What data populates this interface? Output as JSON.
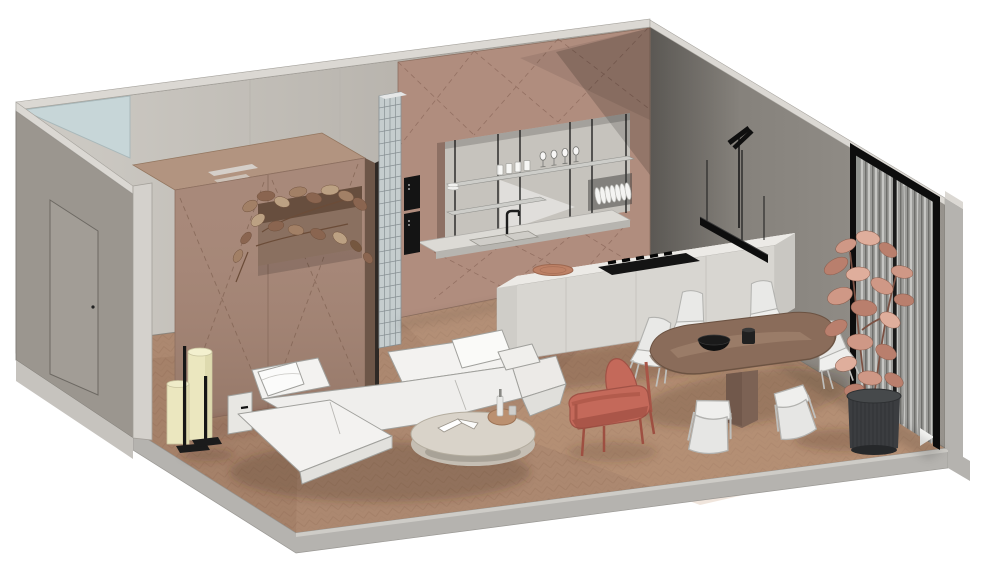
{
  "meta": {
    "title": "Apartment interior - axonometric cutaway 3D render",
    "view": "isometric cutaway on white background",
    "background": "#ffffff"
  },
  "palette": {
    "background": "#ffffff",
    "floor_wood": "#ac8870",
    "floor_line": "#9b7760",
    "slab_face": "#b5b3af",
    "slab_light": "#d0ceca",
    "wall_top_band": "#dbd8d3",
    "wall_light": "#c9c6c0",
    "wall_mid": "#9b968f",
    "wall_dark": "#8e8a83",
    "glass_corner": "#c7d6d8",
    "cabinet": "#b08d7e",
    "cabinet_dark": "#8d7064",
    "cabinet_line": "#8a675a",
    "niche_back": "#c6c3bd",
    "counter": "#dcdad5",
    "glass_block": "#c5cdce",
    "island_top": "#e4e2de",
    "island_front": "#d8d6d1",
    "island_side": "#c9c7c2",
    "appliance_black": "#141414",
    "table_wood": "#8a6c5a",
    "pedestal": "#7c6254",
    "chair_white": "#e9e9e7",
    "sofa_white": "#f3f2f0",
    "coffee_top": "#d9d3c9",
    "coffee_side": "#c5beb3",
    "armchair_red": "#c4695a",
    "lamp_cream": "#ebe7bf",
    "frame_black": "#0d0d0d",
    "curtain_gray": "#9c9c99",
    "plant_pink": "#cf9886",
    "plant_deep": "#b97f6d",
    "plant_pale": "#dfae9c",
    "planter_leaf": "#a28066",
    "pot_dark": "#3b3d40",
    "stem_brown": "#7b5143"
  },
  "scene": {
    "architecture": [
      {
        "name": "floor",
        "desc": "herringbone wood floor on concrete slab with gray cut edges"
      },
      {
        "name": "back-wall",
        "desc": "light gray cut wall with corner clerestory glass triangle"
      },
      {
        "name": "left-wall",
        "desc": "gray wall with entry door and light cut end face"
      },
      {
        "name": "right-wall",
        "desc": "gray wall with black-framed glazing and gray curtains"
      },
      {
        "name": "glass-block-partition",
        "desc": "vertical glass block strip beside tall cabinetry"
      },
      {
        "name": "wardrobe-volume",
        "desc": "dusty-brown joinery volume with recessed planter and trailing plant"
      }
    ],
    "kitchen": {
      "cabinetry": "full-height dusty-mauve panels with dashed door-swing marks",
      "appliances": [
        "two built-in black ovens",
        "black gas cooktop",
        "double sink",
        "black faucet"
      ],
      "niche_shelves": [
        "stacked plates",
        "four tumblers",
        "four wine glasses",
        "plate rack with dishes"
      ],
      "island": "light gray island with black cooktop and terracotta plate",
      "lighting": [
        "black linear pendant on thin cables",
        "black wall-mounted stem light"
      ]
    },
    "dining": {
      "table": "oval wood pedestal dining table",
      "chairs_count": 6,
      "chairs": "white molded chairs with thin metal legs",
      "tabletop_items": [
        "black bowl",
        "black tumbler"
      ]
    },
    "living": {
      "sofa": "white low modular sofa with chaise and loose pillows",
      "coffee_table": "cream oval coffee table with open book, tray, bottle and cup",
      "armchair": "terracotta-red lounge chair with wood frame",
      "floor_lamp": "two cream cylinder shades on black stands",
      "plant": "potted fig with salmon-pink leaves in dark fluted planter"
    }
  }
}
